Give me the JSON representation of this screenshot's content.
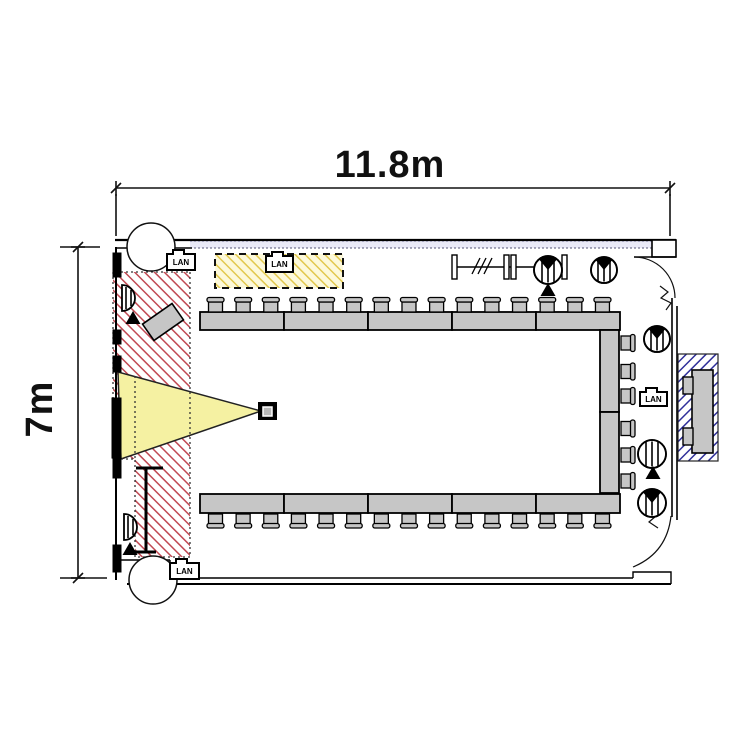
{
  "dimension_labels": {
    "width": "11.8m",
    "height": "7m"
  },
  "lan_label": "LAN",
  "room": {
    "tables_top": 5,
    "tables_bottom": 5,
    "tables_right": 2,
    "tables_outside": 1,
    "chairs_top": 15,
    "chairs_bottom": 15,
    "chairs_right": 6,
    "chairs_outside": 2,
    "ceiling_speakers": 7,
    "floor_mic_points": 4,
    "lan_ports": 4
  },
  "colors": {
    "wall": "#000000",
    "table_fill": "#c6c6c6",
    "beam_fill": "#f5f1a2",
    "red_hatch": "#c14953",
    "yellow_hatch": "#e2c84e",
    "yellow_zone_bg": "#fdf9da",
    "blue_hatch": "#30309a",
    "window_band": "#e9e9f7"
  }
}
